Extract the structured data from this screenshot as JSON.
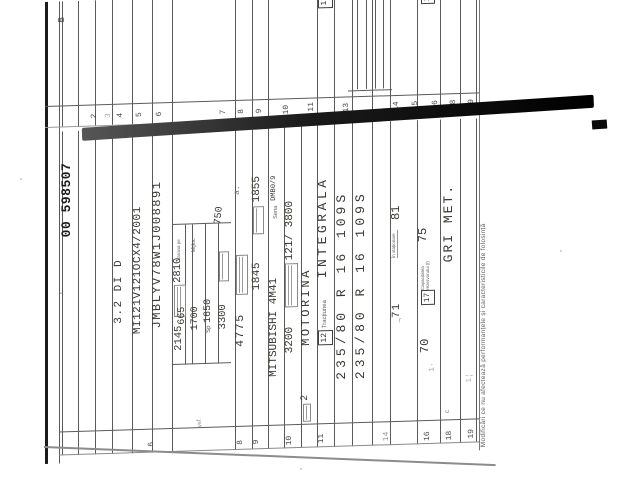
{
  "document": {
    "serial": "00 598507",
    "section_marker": "B",
    "handwritten_note": "vsf.",
    "footer": "Modificări ce nu afectează performanțele și caracteristicile de folosință",
    "fields": {
      "type_variant": "3.2 DI D",
      "approval_number": "MI121V121OCX4/2001",
      "vin": "JMBLYV78W1J008891",
      "mass_own": "2145",
      "mass_max": "2810",
      "axle_label": "Sarcina pe",
      "axle_mid_label": "Mijloc",
      "axle_value_1": "665",
      "axle_value_2": "1700",
      "axle_value_3_prefix": "Sp",
      "axle_value_3": "1650",
      "tow_braked": "3300",
      "tow_unbraked": "750",
      "length": "4775",
      "width": "1845",
      "height": "1855",
      "engine_type": "MITSUBISHI 4M41",
      "engine_series_label": "Seria",
      "engine_series": "DMB0/9",
      "displacement": "3200",
      "power_rpm": "121/ 3800",
      "cylinders": "2",
      "fuel": "MOTORINA",
      "traction_label": "Tracțiunea",
      "traction": "INTEGRALA",
      "tyre_front": "235/80 R 16 109S",
      "tyre_rear": "235/80 R 16 109S",
      "noise_drive": "71",
      "noise_label": "În staționare",
      "noise_standing": "81",
      "field16_value": "70",
      "tank_label": "Capacitatea rezervorului (l)",
      "tank_capacity": "75",
      "colour_caption_initial": "c",
      "colour": "GRI MET.",
      "mark_a": "a."
    },
    "inline_field_numbers": {
      "f12": "12",
      "f17": "17"
    },
    "left_row_numbers": {
      "n6": "6",
      "n8": "8",
      "n9": "9",
      "n10": "10",
      "n11": "11",
      "n14": "14",
      "n16": "16",
      "n18": "18",
      "n19": "19"
    },
    "right_row_numbers": {
      "n2": "2",
      "n3": "3",
      "n4": "4",
      "n5": "5",
      "n6": "6",
      "n7": "7",
      "n8": "8",
      "n9": "9",
      "n10": "10",
      "n11": "11",
      "n13": "13",
      "n14": "14",
      "n15": "15",
      "n16": "16",
      "n18": "18",
      "n19": "19"
    }
  }
}
